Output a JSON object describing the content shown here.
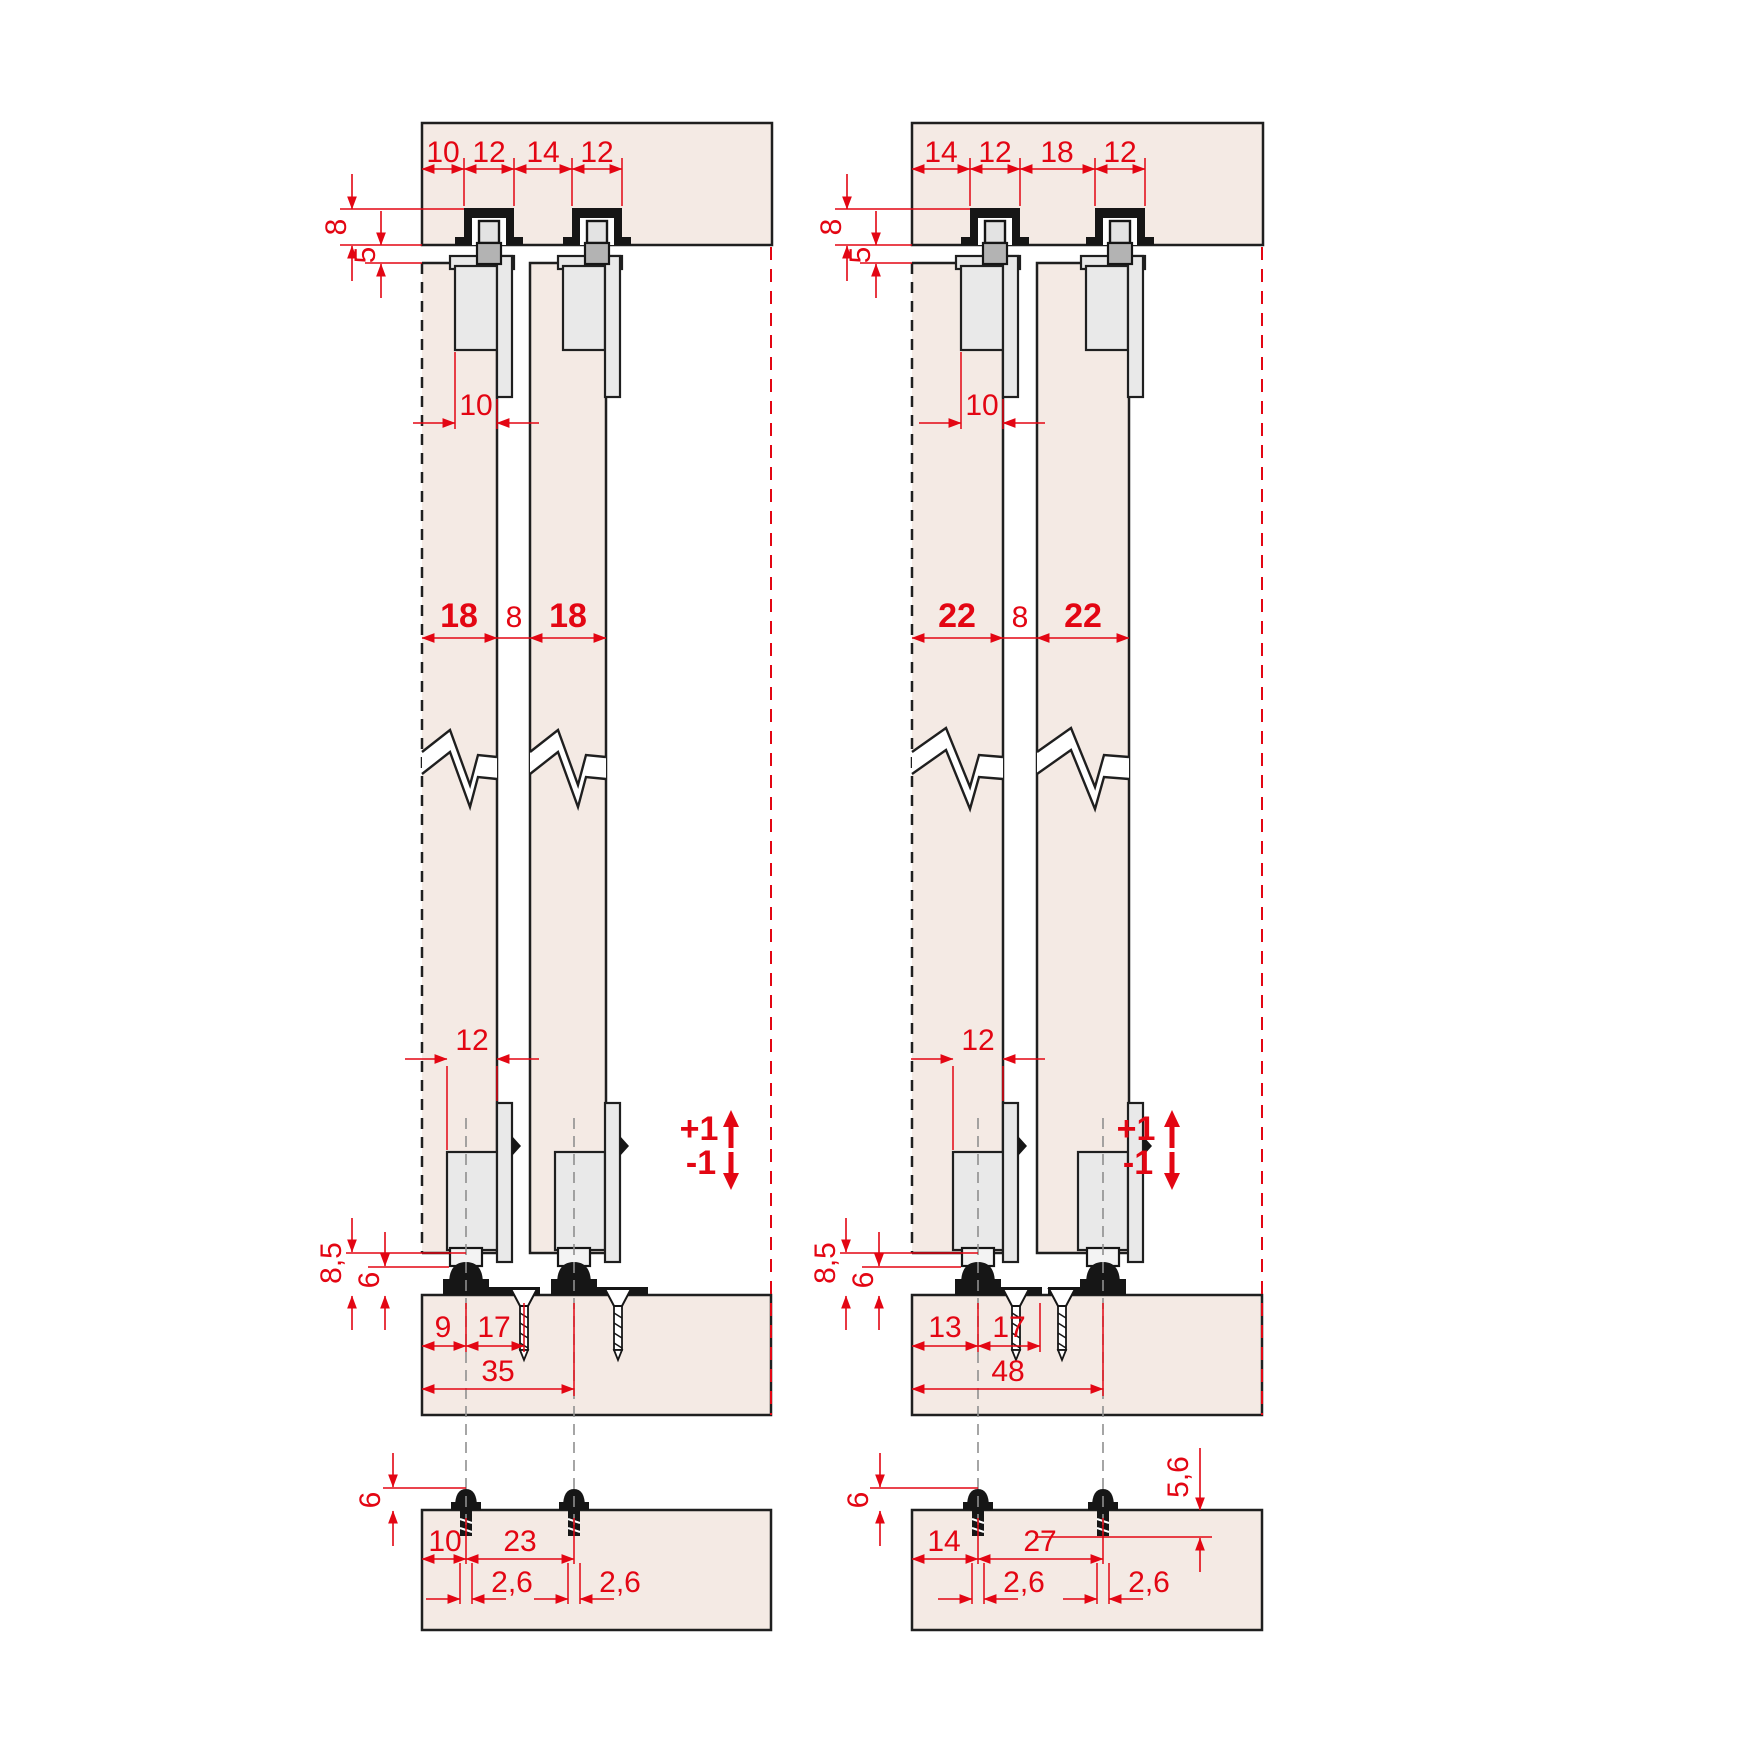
{
  "colors": {
    "red": "#e30613",
    "panel": "#f4eae4",
    "hardware": "#e9e9e9",
    "line": "#1f1f1f"
  },
  "left": {
    "top_dims": [
      "10",
      "12",
      "14",
      "12"
    ],
    "recess_depth": "8",
    "gap_top": "5",
    "hanger_inset": "10",
    "door1_thickness": "18",
    "door_gap": "8",
    "door2_thickness": "18",
    "guide_width": "12",
    "bottom_clearance": "8,5",
    "guide_height": "6",
    "edge_to_guide": "9",
    "guide_to_screw": "17",
    "edge_to_guide2": "35",
    "adjust_plus": "+1",
    "adjust_minus": "-1",
    "pin_height": "6",
    "edge_to_hole": "10",
    "hole_spacing": "23",
    "hole_dia1": "2,6",
    "hole_dia2": "2,6"
  },
  "right": {
    "top_dims": [
      "14",
      "12",
      "18",
      "12"
    ],
    "recess_depth": "8",
    "gap_top": "5",
    "hanger_inset": "10",
    "door1_thickness": "22",
    "door_gap": "8",
    "door2_thickness": "22",
    "guide_width": "12",
    "bottom_clearance": "8,5",
    "guide_height": "6",
    "edge_to_guide": "13",
    "guide_to_screw": "17",
    "edge_to_guide2": "48",
    "adjust_plus": "+1",
    "adjust_minus": "-1",
    "pin_height": "6",
    "pin_depth": "5,6",
    "edge_to_hole": "14",
    "hole_spacing": "27",
    "hole_dia1": "2,6",
    "hole_dia2": "2,6"
  }
}
